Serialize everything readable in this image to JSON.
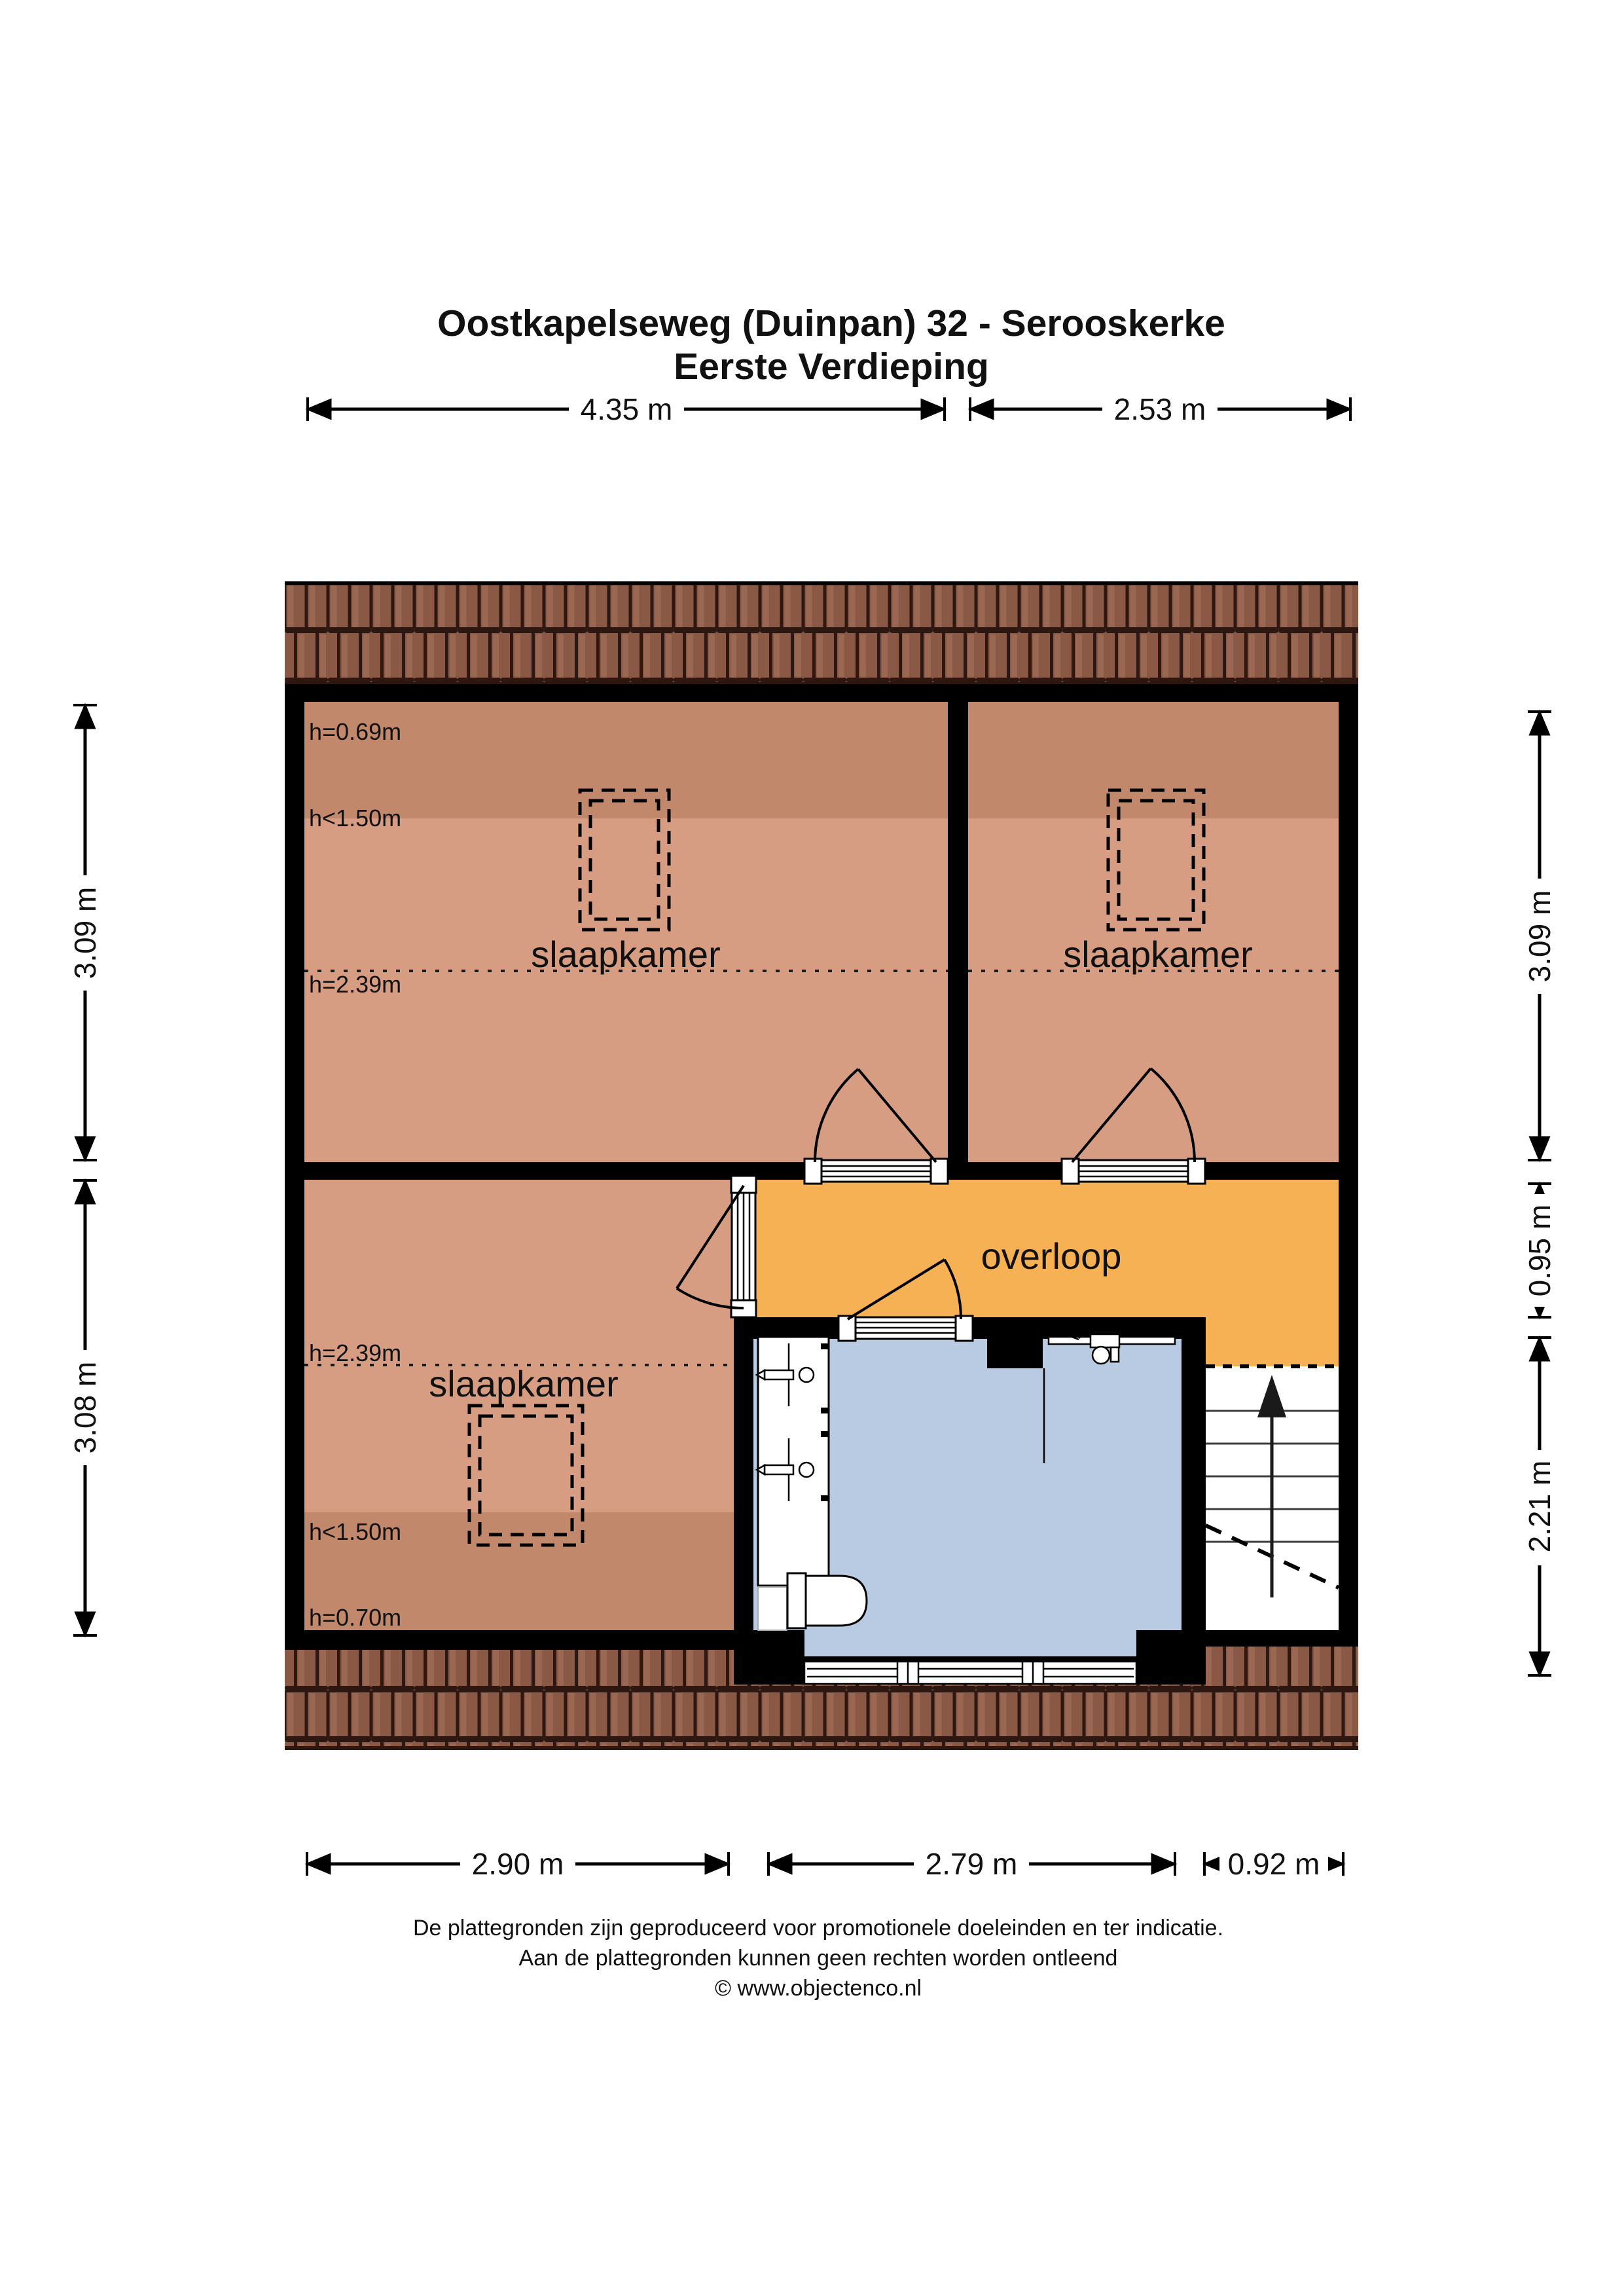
{
  "title": {
    "line1": "Oostkapelseweg (Duinpan) 32 - Serooskerke",
    "line2": "Eerste Verdieping"
  },
  "dimensions": {
    "top": [
      {
        "label": "4.35 m"
      },
      {
        "label": "2.53 m"
      }
    ],
    "bottom": [
      {
        "label": "2.90 m"
      },
      {
        "label": "2.79 m"
      },
      {
        "label": "0.92 m"
      }
    ],
    "left": [
      {
        "label": "3.09 m"
      },
      {
        "label": "3.08 m"
      }
    ],
    "right": [
      {
        "label": "3.09 m"
      },
      {
        "label": "0.95 m"
      },
      {
        "label": "2.21 m"
      }
    ]
  },
  "rooms": {
    "bedroom_top_left": {
      "label": "slaapkamer",
      "h_top": "h=0.69m",
      "h_mid": "h<1.50m",
      "h_bottom": "h=2.39m"
    },
    "bedroom_top_right": {
      "label": "slaapkamer"
    },
    "bedroom_bottom_left": {
      "label": "slaapkamer",
      "h_top": "h=2.39m",
      "h_mid": "h<1.50m",
      "h_bottom": "h=0.70m"
    },
    "landing": {
      "label": "overloop"
    }
  },
  "footer": {
    "line1": "De plattegronden zijn geproduceerd voor promotionele doeleinden en ter indicatie.",
    "line2": "Aan de plattegronden kunnen geen rechten worden ontleend",
    "line3": "© www.objectenco.nl"
  },
  "colors": {
    "wall": "#000000",
    "room_fill": "#d69d82",
    "room_fill_shaded": "#c2886c",
    "landing_fill": "#f7b155",
    "bathroom_fill": "#b8cbe3",
    "roof_tile": "#8a5946",
    "roof_gap": "#2e1710",
    "stairs": "#ffffff"
  }
}
